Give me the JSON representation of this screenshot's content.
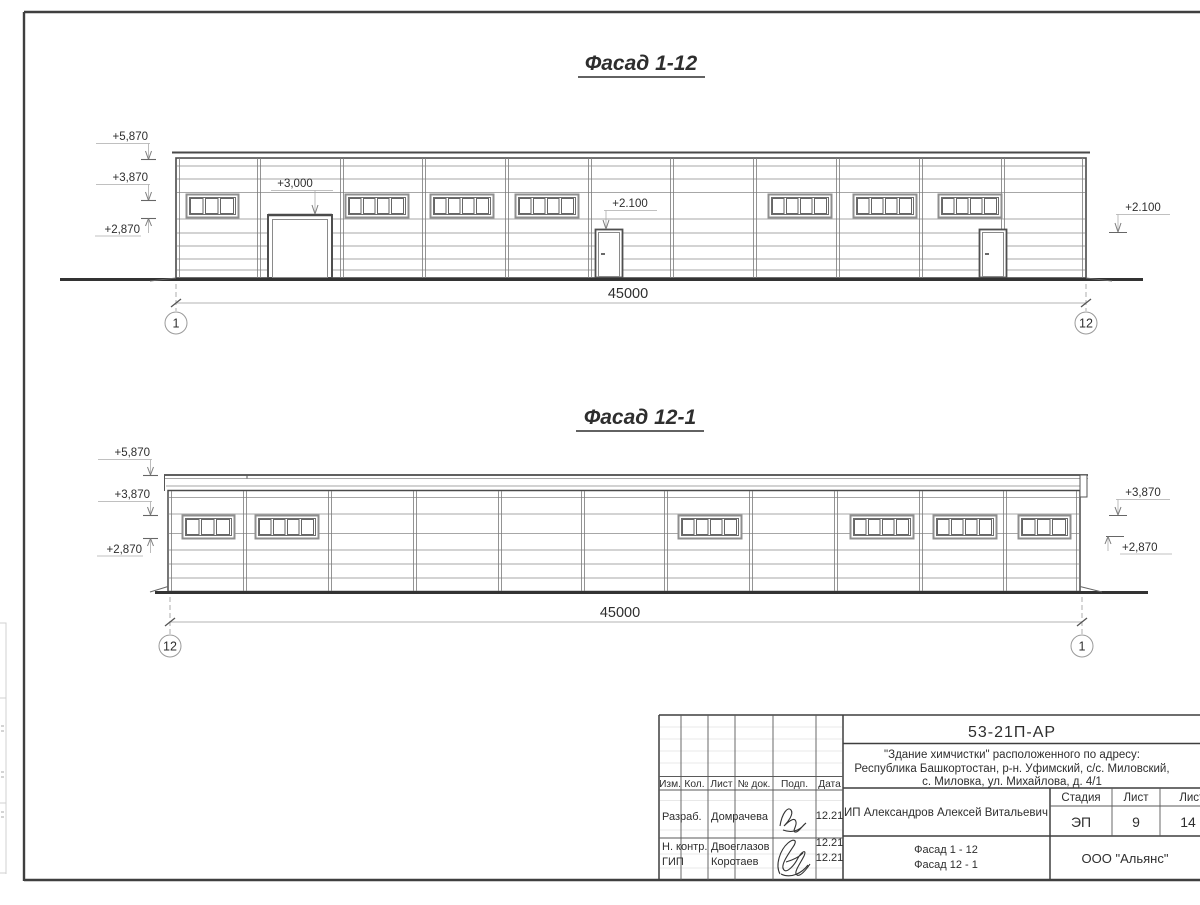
{
  "palette": {
    "paper": "#ffffff",
    "ink": "#2e2e2e",
    "line_dark": "#4a4a4a",
    "line_mid": "#8a8a8a",
    "line_light": "#c9c9c9"
  },
  "facade_1_12": {
    "title": "Фасад 1-12",
    "dimension": "45000",
    "axis_left": "1",
    "axis_right": "12",
    "elev_5870": "+5,870",
    "elev_3870": "+3,870",
    "elev_2870": "+2,870",
    "elev_3000": "+3,000",
    "elev_2100_door": "+2.100",
    "elev_2100_right": "+2.100"
  },
  "facade_12_1": {
    "title": "Фасад 12-1",
    "dimension": "45000",
    "axis_left": "12",
    "axis_right": "1",
    "elev_5870": "+5,870",
    "elev_3870": "+3,870",
    "elev_2870": "+2,870",
    "elev_3870_right": "+3,870",
    "elev_2870_right": "+2,870"
  },
  "title_block": {
    "document_number": "53-21П-АР",
    "project_line1": "\"Здание химчистки\" расположенного по адресу:",
    "project_line2": "Республика Башкортостан, р-н. Уфимский, с/с. Миловский,",
    "project_line3": "с. Миловка, ул. Михайлова, д. 4/1",
    "client": "ИП Александров Алексей Витальевич",
    "stage_label": "Стадия",
    "sheet_label": "Лист",
    "sheets_label": "Листов",
    "stage_value": "ЭП",
    "sheet_value": "9",
    "sheets_value": "14",
    "sheet_title_line1": "Фасад 1 - 12",
    "sheet_title_line2": "Фасад 12 - 1",
    "organization": "ООО \"Альянс\"",
    "columns": {
      "izm": "Изм.",
      "kol": "Кол.",
      "list": "Лист",
      "ndoc": "№ док.",
      "podp": "Подп.",
      "data": "Дата"
    },
    "signers": [
      {
        "role": "Разраб.",
        "name": "Домрачева",
        "date": "12.21"
      },
      {
        "role": "Н. контр.",
        "name": "Двоеглазов",
        "date": "12.21"
      },
      {
        "role": "ГИП",
        "name": "Коротаев",
        "date": "12.21"
      }
    ]
  }
}
